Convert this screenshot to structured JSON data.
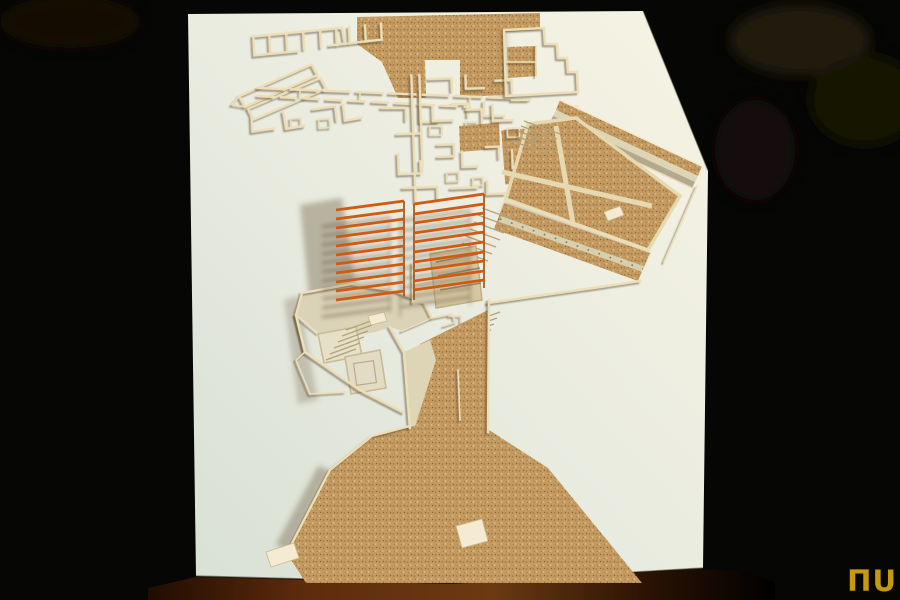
{
  "scene": {
    "description": "Photograph of a cardboard architectural site model (excavation-plan style) glued on white paper, lit from the upper right, on a dark table against a black background",
    "louver_slats_left": 11,
    "louver_slats_right": 10
  },
  "logo": {
    "text": "ΠU"
  },
  "palette": {
    "bg": "#060605",
    "paper_hi": "#f6f3e3",
    "paper": "#eaece0",
    "paper_lo": "#d9e0d4",
    "cork": "#c39a61",
    "cork_dot_dark": "#a67b42",
    "cork_dot_deep": "#8f6530",
    "cork_dot_light": "#dcb87e",
    "wall": "#ecdfb8",
    "wall_bright": "#f4ebd2",
    "platform": "#dbd3b8",
    "walkway": "#ded5b6",
    "slat": "#cf5a14",
    "post": "#9c4a12",
    "table_edge": "#5e2c0c",
    "table_edge_dark": "#200c02",
    "logo_gold": "#c7990e"
  }
}
